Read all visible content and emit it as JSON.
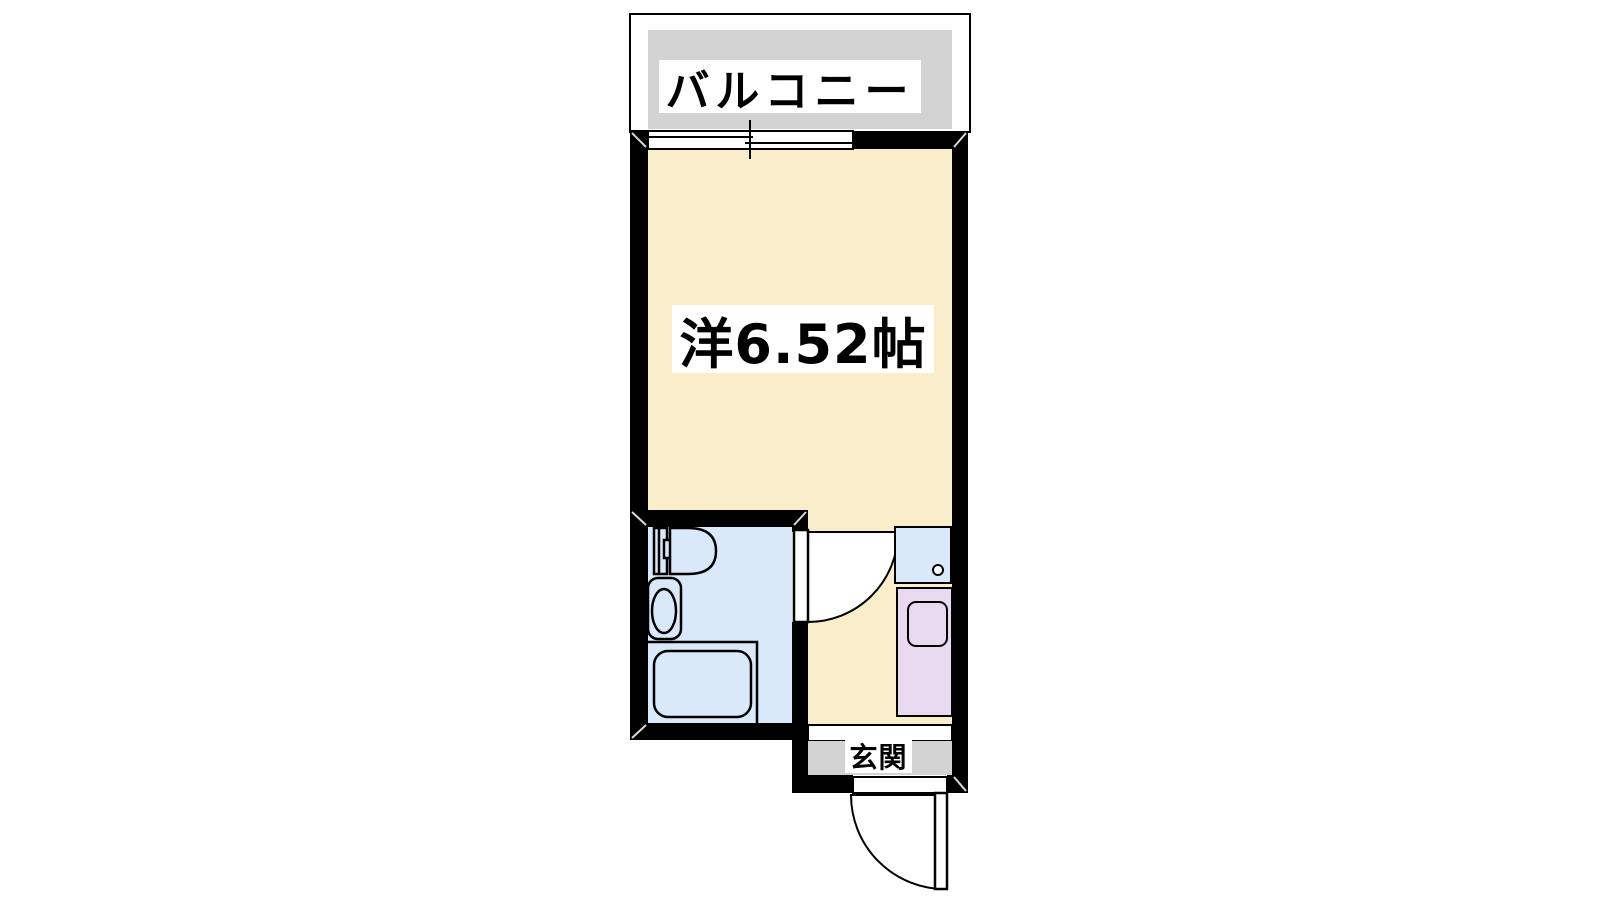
{
  "page": {
    "type": "apartment-floor-plan",
    "background": "#ffffff"
  },
  "colors": {
    "wall": "#000000",
    "room_floor": "#faedc9",
    "bathroom_floor": "#d9e9fa",
    "kitchen_counter": "#e9d9f1",
    "balcony_floor": "#d3d3d3",
    "label_background": "#ffffff",
    "line": "#000000"
  },
  "labels": {
    "balcony": "バルコニー",
    "main_room": "洋6.52帖",
    "entrance": "玄関"
  },
  "icons": {
    "window": "sliding-window-icon",
    "toilet": "toilet-icon",
    "washbasin": "washbasin-icon",
    "bathtub": "bathtub-icon",
    "kitchen_sink": "kitchen-sink-icon",
    "kitchen_counter": "kitchen-counter-icon",
    "bathroom_door": "door-swing-icon",
    "entrance_door": "door-swing-icon"
  }
}
